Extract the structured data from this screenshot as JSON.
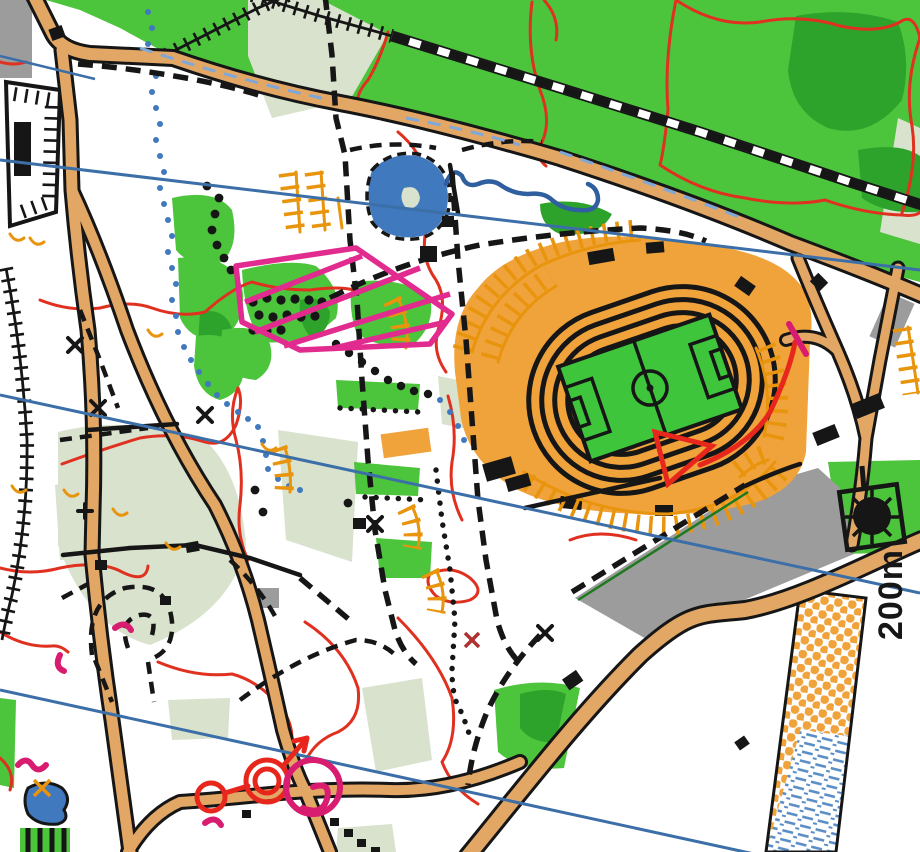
{
  "map": {
    "kind": "scanned orienteering map of a park with athletics stadium",
    "scale_label": "200m",
    "scale_label_rotation_deg": -90
  },
  "palette": {
    "paper": "#ffffff",
    "road_tan": "#e3a765",
    "stadium_orange": "#f0a23b",
    "steps_orange": "#e8940c",
    "vegetation_green": "#4cc43c",
    "vegetation_dark_green": "#2ea32b",
    "vegetation_pale_sage": "#d9e2cd",
    "pitch_green": "#3ec53c",
    "water_blue": "#4079be",
    "stream_blue": "#2f5f9e",
    "north_line_blue": "#3c6fa8",
    "road_marking_light_blue": "#7fa8d8",
    "contour_red": "#e03020",
    "out_of_bounds_magenta": "#e22b8e",
    "course_overprint_red": "#e8271c",
    "course_overprint_crimson": "#d81c6f",
    "paved_gray": "#9c9c9c",
    "building_black": "#161616"
  },
  "features": {
    "stadium": {
      "track_rings": 4,
      "pitch": "football pitch with centre circle, centre line, penalty and goal boxes",
      "surround": "orange spectator area with step/terrace tick marks"
    },
    "course_overprint": [
      "red start triangle inside stadium",
      "red route line with crimson crossing bar east of stadium",
      "small red circle, double red finish circle and arrowed line near south-west",
      "crimson circle with spiral flourish"
    ],
    "out_of_bounds": "magenta hatched polygon north-west of stadium",
    "linework": [
      "tan roads with black casings",
      "black-and-white dashed railway",
      "black dashed footpath network",
      "black dotted vegetation boundaries",
      "straight blue magnetic north lines",
      "red contour lines",
      "blue dotted seasonal stream",
      "black tick fence along west edge"
    ],
    "areas": [
      "large green woodland top right",
      "pale sage rough-open patches",
      "gray paved terrace south-east",
      "banded rectangle with orange dot screen and blue marsh dashes bottom right",
      "blue ponds with dashed margins",
      "green square with black fountain circle east"
    ]
  }
}
